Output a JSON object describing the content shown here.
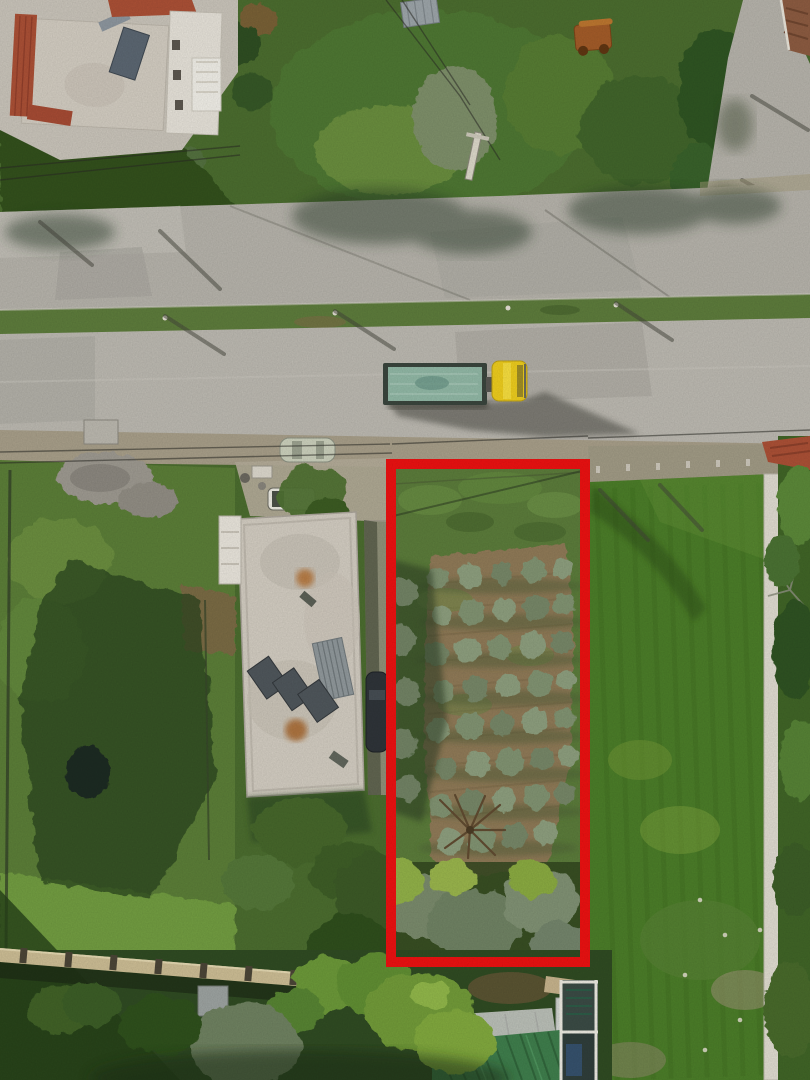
{
  "meta": {
    "description": "Aerial drone photograph of a rural neighborhood: an asphalt road with a grass median runs across the top, a yellow truck with a teal-covered flatbed drives on it, and a vacant olive-grove parcel below the road is outlined with a thick red rectangle between a white flat-roofed warehouse, a lush green field and greenhouse sheds.",
    "image_type": "aerial-photo",
    "visible_text": "none"
  },
  "palette": {
    "boundary_red": "#e81111",
    "road": "#b9b6ae",
    "service_road": "#b3b0a8",
    "shoulder": "#a59c87",
    "median_grass": "#5c7a3b",
    "vegetation_base": "#4a6b2e",
    "parcel_grass": "#5a7c37",
    "field_green": "#4a7b28",
    "soil_brown": "#8d7856",
    "olive_canopy": "#7f9170",
    "bright_canopy": "#8fae46",
    "building_roof": "#cfc9be",
    "tile_red": "#a84f35",
    "concrete_white": "#dcd8cd",
    "truck_yellow": "#e9c91d",
    "tarp_teal": "#8fb5a3",
    "green_metal_roof": "#3e7c4b",
    "wall_beige": "#c9ba92",
    "shadow_dark": "#26401c"
  },
  "boundary_box": {
    "shape": "rectangle",
    "x": 386,
    "y": 459,
    "width": 204,
    "height": 508,
    "stroke_width": 10,
    "meaning": "highlighted land parcel boundary"
  },
  "objects": [
    {
      "label": "asphalt road with grass median strip",
      "position": "upper band"
    },
    {
      "label": "yellow truck pulling flatbed trailer with teal tarp",
      "position": "center of road"
    },
    {
      "label": "white flat-roof house with red tile edging and solar water heater",
      "position": "top left"
    },
    {
      "label": "neighbor house with brown tile roof",
      "position": "top right corner"
    },
    {
      "label": "side road",
      "position": "top right"
    },
    {
      "label": "rusty farm equipment",
      "position": "top right field"
    },
    {
      "label": "utility poles, power lines and diagonal pole shadows",
      "position": "along road"
    },
    {
      "label": "gravel pile and fenced grass parcel with burnt patch",
      "position": "left of boundary"
    },
    {
      "label": "white warehouse building with metal sheets and rust stains on roof",
      "position": "center left"
    },
    {
      "label": "parked cars (silver, white pickup, dark car)",
      "position": "beside warehouse"
    },
    {
      "label": "olive grove rows on brown tilled soil inside red boundary",
      "position": "center"
    },
    {
      "label": "dense tree canopies",
      "position": "bottom of boundary parcel"
    },
    {
      "label": "lush green crop field",
      "position": "right of boundary"
    },
    {
      "label": "white perimeter wall segments",
      "position": "far right"
    },
    {
      "label": "red tile roof edge",
      "position": "right edge at road"
    },
    {
      "label": "beige-capped boundary wall with posts",
      "position": "bottom left"
    },
    {
      "label": "greenhouse with white panel roof and green corrugated metal roof shed",
      "position": "bottom center"
    }
  ]
}
